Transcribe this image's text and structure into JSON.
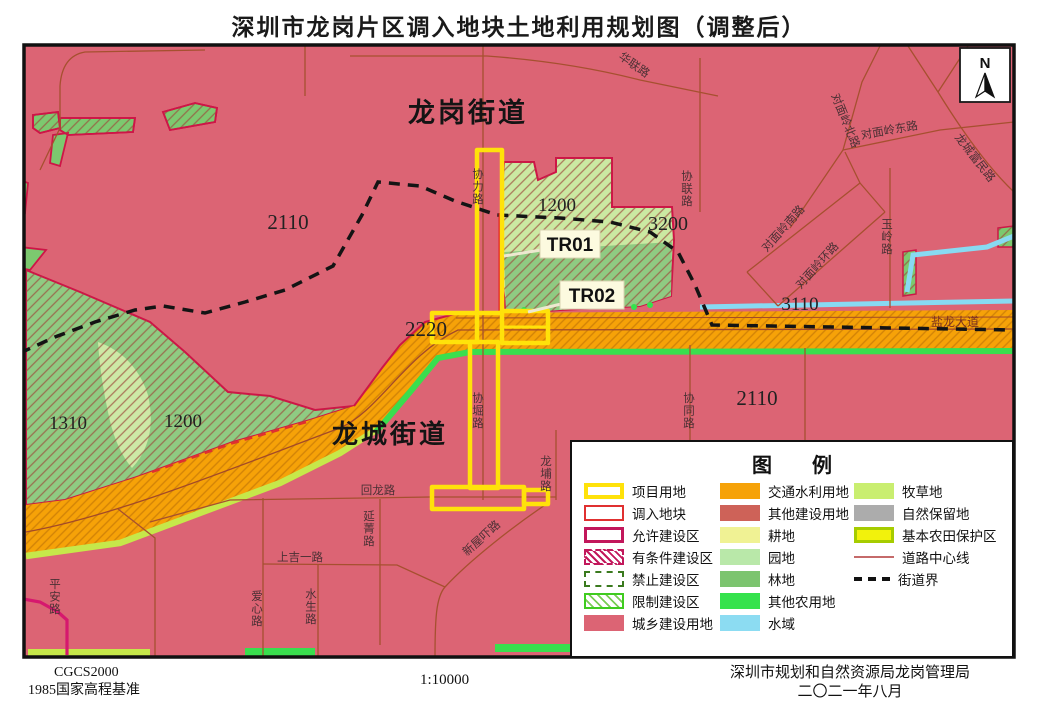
{
  "title": "深圳市龙岗片区调入地块土地利用规划图（调整后）",
  "compass_label": "N",
  "map": {
    "districts": {
      "longgang": "龙岗街道",
      "longcheng": "龙城街道"
    },
    "parcels": {
      "tr01": "TR01",
      "tr02": "TR02"
    },
    "codes": {
      "nw": "2110",
      "mid": "1200",
      "ne": "3200",
      "road_w": "2220",
      "w1": "1310",
      "w2": "1200",
      "road_e": "3110",
      "se": "2110"
    },
    "roads": {
      "hualian": "华联路",
      "xieli": "协力路",
      "xielian": "协联路",
      "dml_north": "对面岭北路",
      "dml_east": "对面岭东路",
      "lcfm": "龙城富民路",
      "dml_south": "对面岭南路",
      "dml_ring": "对面岭环路",
      "yuling": "玉岭路",
      "xietong": "协同路",
      "yanlong": "盐龙大道",
      "huilong": "回龙路",
      "yanjing": "延菁路",
      "shangjiyi": "上吉一路",
      "xinwuxia": "新屋吓路",
      "longpu": "龙埔路",
      "xieduan": "协堀路",
      "aixin": "爱心路",
      "shuisheng": "水生路",
      "pingan": "平安路"
    }
  },
  "legend": {
    "title": "图　　例",
    "items": [
      {
        "id": "project",
        "label": "项目用地"
      },
      {
        "id": "import",
        "label": "调入地块"
      },
      {
        "id": "allowed",
        "label": "允许建设区"
      },
      {
        "id": "conditional",
        "label": "有条件建设区"
      },
      {
        "id": "forbidden",
        "label": "禁止建设区"
      },
      {
        "id": "restricted",
        "label": "限制建设区"
      },
      {
        "id": "urban",
        "label": "城乡建设用地"
      },
      {
        "id": "traffic",
        "label": "交通水利用地"
      },
      {
        "id": "other_construction",
        "label": "其他建设用地"
      },
      {
        "id": "farmland",
        "label": "耕地"
      },
      {
        "id": "orchard",
        "label": "园地"
      },
      {
        "id": "forest",
        "label": "林地"
      },
      {
        "id": "other_agri",
        "label": "其他农用地"
      },
      {
        "id": "water",
        "label": "水域"
      },
      {
        "id": "pasture",
        "label": "牧草地"
      },
      {
        "id": "natural_reserve",
        "label": "自然保留地"
      },
      {
        "id": "basic_farm",
        "label": "基本农田保护区"
      },
      {
        "id": "road_centerline",
        "label": "道路中心线"
      },
      {
        "id": "street_boundary",
        "label": "街道界"
      }
    ]
  },
  "footer": {
    "datum1": "CGCS2000",
    "datum2": "1985国家高程基准",
    "scale": "1:10000",
    "agency": "深圳市规划和自然资源局龙岗管理局",
    "date": "二〇二一年八月"
  },
  "colors": {
    "urban_bg": "#DC6474",
    "road_orange": "#F6A208",
    "project_yellow": "#FFE20A",
    "import_red": "#E03030",
    "allowed_crimson": "#C2175B",
    "restricted_green_fill": "#8FCB82",
    "restricted_green_light": "#CBE9A2",
    "water_blue": "#88DAF2",
    "other_agri_green": "#35E24D",
    "pasture_strip": "#C6E84A",
    "boundary_black": "#141414"
  }
}
